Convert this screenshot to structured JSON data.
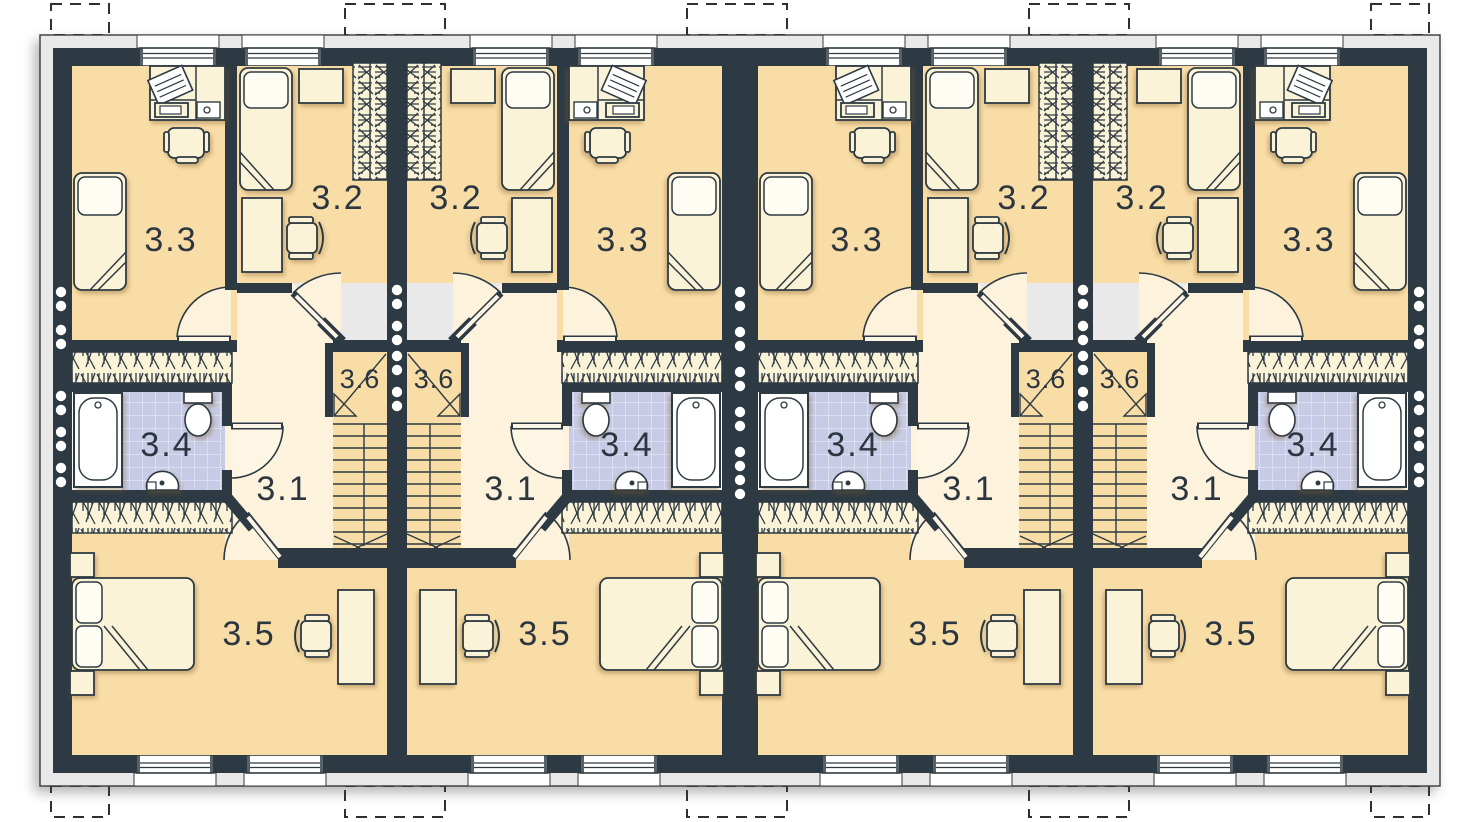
{
  "plan": {
    "unit_count": 4,
    "room_labels": {
      "hall": "3.1",
      "bedroom_upper": "3.2",
      "bedroom_large": "3.3",
      "bathroom": "3.4",
      "bedroom_lower": "3.5",
      "staircase": "3.6"
    },
    "colors": {
      "wall": "#2e3a43",
      "floor": "#f9dda7",
      "hall_floor": "#fdf3dd",
      "bathroom_floor": "#c7cbe5",
      "furniture": "#fbf3d8",
      "pillow": "#fefcf3",
      "outer_band": "#e9e9e9",
      "fixture_white": "#ffffff",
      "background": "#ffffff"
    }
  }
}
